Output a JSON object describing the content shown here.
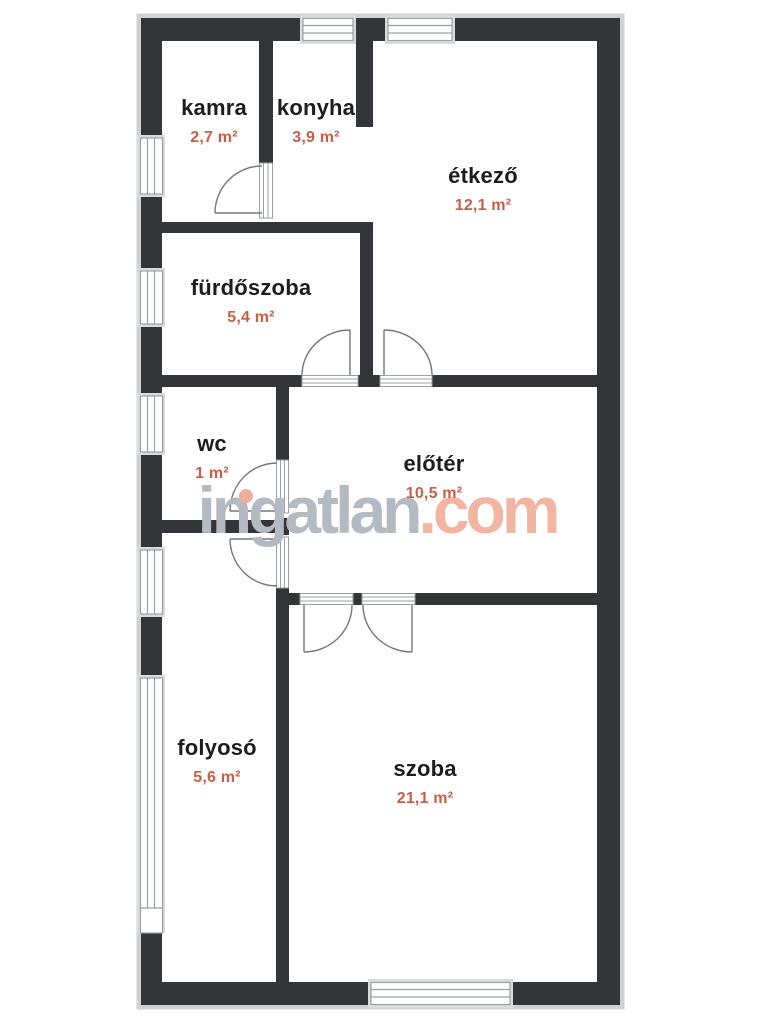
{
  "watermark": {
    "main": "ingatlan",
    "accent": ".com"
  },
  "rooms": {
    "kamra": {
      "name": "kamra",
      "area": "2,7 m²"
    },
    "konyha": {
      "name": "konyha",
      "area": "3,9 m²"
    },
    "etkezo": {
      "name": "étkező",
      "area": "12,1 m²"
    },
    "furdoszoba": {
      "name": "fürdőszoba",
      "area": "5,4 m²"
    },
    "wc": {
      "name": "wc",
      "area": "1 m²"
    },
    "eloter": {
      "name": "előtér",
      "area": "10,5 m²"
    },
    "folyoso": {
      "name": "folyosó",
      "area": "5,6 m²"
    },
    "szoba": {
      "name": "szoba",
      "area": "21,1 m²"
    }
  },
  "colors": {
    "wall": "#343539",
    "room_name": "#1d1d1f",
    "area_text": "#c85e45",
    "watermark_gray": "#b4bac1",
    "watermark_accent": "#f2b5a2",
    "window_frame": "#9aa0a4"
  }
}
